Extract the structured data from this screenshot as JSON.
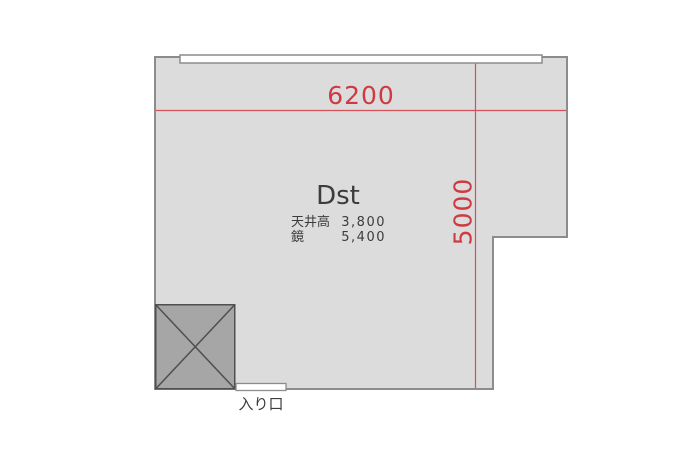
{
  "plan": {
    "room_label": "Dst",
    "specs": [
      {
        "label": "天井高",
        "value": "3,800"
      },
      {
        "label": "鏡",
        "value": "5,400"
      }
    ],
    "dimensions": {
      "width": "6200",
      "height": "5000"
    },
    "entrance_label": "入り口"
  },
  "colors": {
    "background": "#ffffff",
    "room_fill": "#dcdcdc",
    "wall_stroke": "#8c8c8c",
    "pillar_fill": "#a6a6a6",
    "pillar_stroke": "#4f4f4f",
    "dimension_red": "#cf3a42",
    "text_dark": "#3c3c3c",
    "mirror_fill": "#ffffff",
    "door_fill": "#ffffff"
  }
}
